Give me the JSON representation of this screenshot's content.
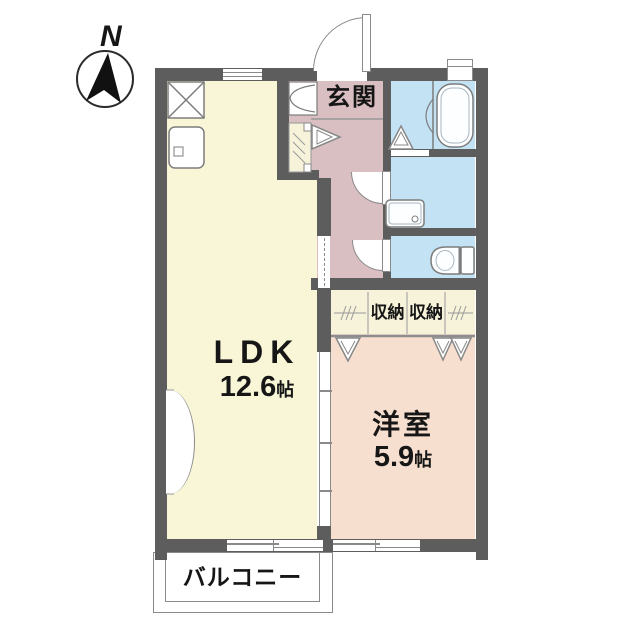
{
  "compass": {
    "north_label": "N"
  },
  "rooms": {
    "ldk": {
      "label": "LDK",
      "area_value": "12.6",
      "area_unit": "帖"
    },
    "western": {
      "label": "洋室",
      "area_value": "5.9",
      "area_unit": "帖"
    },
    "entrance": {
      "label": "玄関"
    },
    "storage_left": {
      "label": "収納"
    },
    "storage_right": {
      "label": "収納"
    },
    "balcony": {
      "label": "バルコニー"
    }
  },
  "fixture_icons": [
    "north-arrow-icon",
    "refrigerator-space-icon",
    "kitchen-sink-icon",
    "shoe-cabinet-icon",
    "hall-closet-icon",
    "bathtub-icon",
    "shower-door-icon",
    "bath-folding-door-icon",
    "washbasin-icon",
    "toilet-icon",
    "folding-door-icon",
    "entrance-door-icon",
    "sliding-window-icon"
  ],
  "colors": {
    "wall": "#5d5d5d",
    "ldk": "#f8f6d7",
    "hall": "#d9bfc1",
    "wet": "#c3e2f4",
    "west": "#f7dfd0",
    "closet": "#f6f3da",
    "line": "#8a8a8a",
    "ink": "#161616"
  }
}
